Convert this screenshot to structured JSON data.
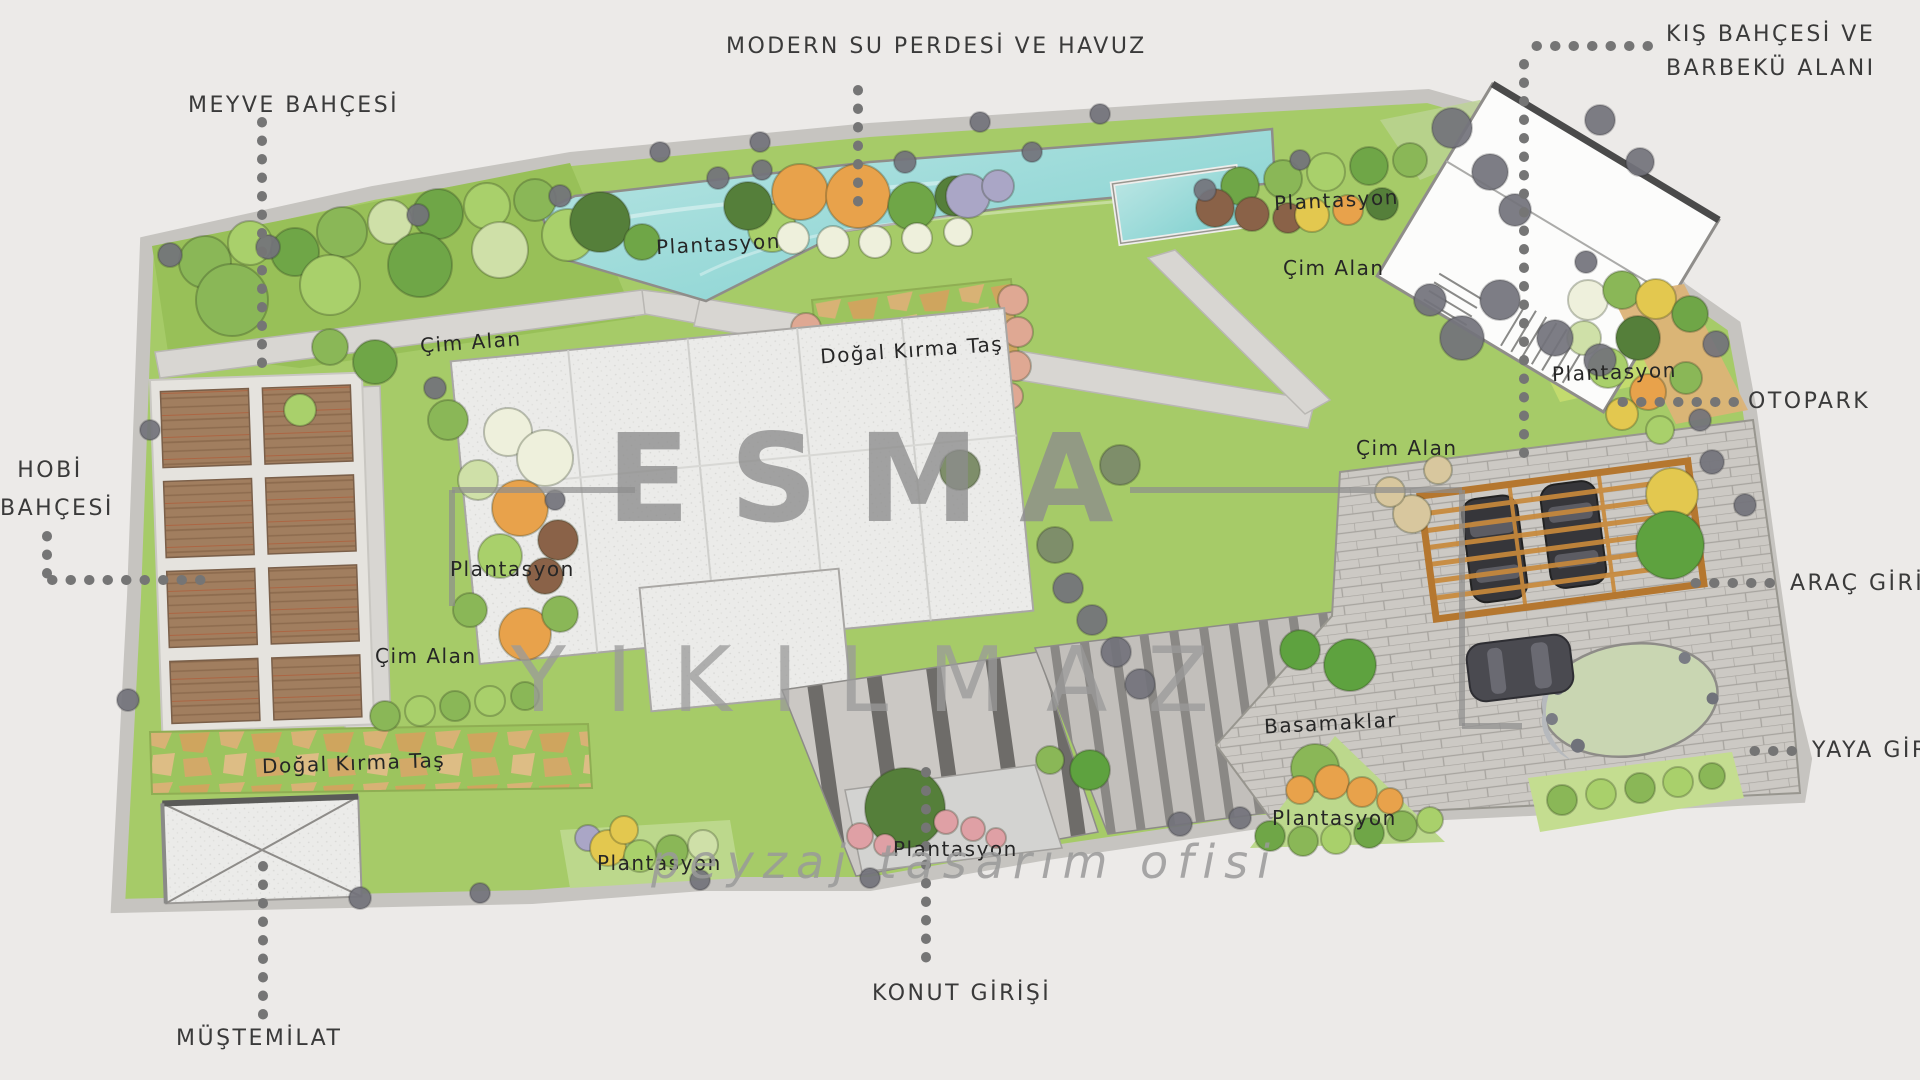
{
  "plan": {
    "watermark": {
      "brand_first": "ESMA",
      "brand_last": "YIKILMAZ",
      "tagline": "peyzaj tasarım ofisi"
    },
    "callouts": {
      "meyve_bahcesi": "MEYVE BAHÇESİ",
      "modern_su_perdesi": "MODERN SU PERDESİ VE HAVUZ",
      "kis_bahcesi_line1": "KIŞ BAHÇESİ VE",
      "kis_bahcesi_line2": "BARBEKÜ ALANI",
      "otopark": "OTOPARK",
      "arac_girisi": "ARAÇ GİRİŞİ",
      "yaya_girisi": "YAYA GİRİŞİ",
      "hobi_line1": "HOBİ",
      "hobi_line2": "BAHÇESİ",
      "mustemilat": "MÜŞTEMİLAT",
      "konut_girisi": "KONUT GİRİŞİ"
    },
    "area_labels": {
      "cim_alan": "Çim Alan",
      "plantasyon": "Plantasyon",
      "dogal_kirma_tas": "Doğal Kırma Taş",
      "basamaklar": "Basamaklar"
    },
    "colors": {
      "bg": "#eceae8",
      "wall": "#c6c4c0",
      "lawn": "#a6cb68",
      "lawn2": "#98c058",
      "lawnlight": "#bcd88c",
      "water1": "#b9e5e3",
      "water2": "#7fd0cf",
      "path": "#d8d6d2",
      "soil": "#a17e5f",
      "soilline": "#8d6b4e",
      "white_path": "#e5e3de",
      "crushbg": "#9cc45e",
      "crush1": "#d8b275",
      "crush2": "#cfa55e",
      "house": "#ebebe9",
      "walklight": "#cbc8c4",
      "walkdark": "#6e6c69",
      "steplight": "#c2bfbb",
      "stepdark": "#8a8885",
      "paver": "#ccc9c4",
      "paverline": "#a7a49f",
      "pergola": "#b5772f",
      "slat": "#c8893b",
      "carbody": "#36363a",
      "carglass": "#5c5c63",
      "tanband": "#dcb377",
      "gravelgreen": "#c9d6b2",
      "gravelgray": "#b6b9bd",
      "label": "#3a3a3a",
      "dot": "#757575",
      "wm": "#8d8d8d",
      "wm2": "#9a9a9a",
      "t1": "#6fa647",
      "t2": "#a9d06b",
      "t3": "#557f3a",
      "t4": "#8ab757",
      "t5": "#e8a24b",
      "t6": "#e3c84f",
      "t7": "#8a6248",
      "t8": "#eef0dc",
      "t9": "#dfa893",
      "t10": "#aaa6c6",
      "t11": "#cfe0a8",
      "t12": "#7e8e6a",
      "t13": "#5ea23f",
      "t14": "#d8c79e",
      "gt": "#73737b",
      "pink": "#dfa0a5"
    }
  }
}
